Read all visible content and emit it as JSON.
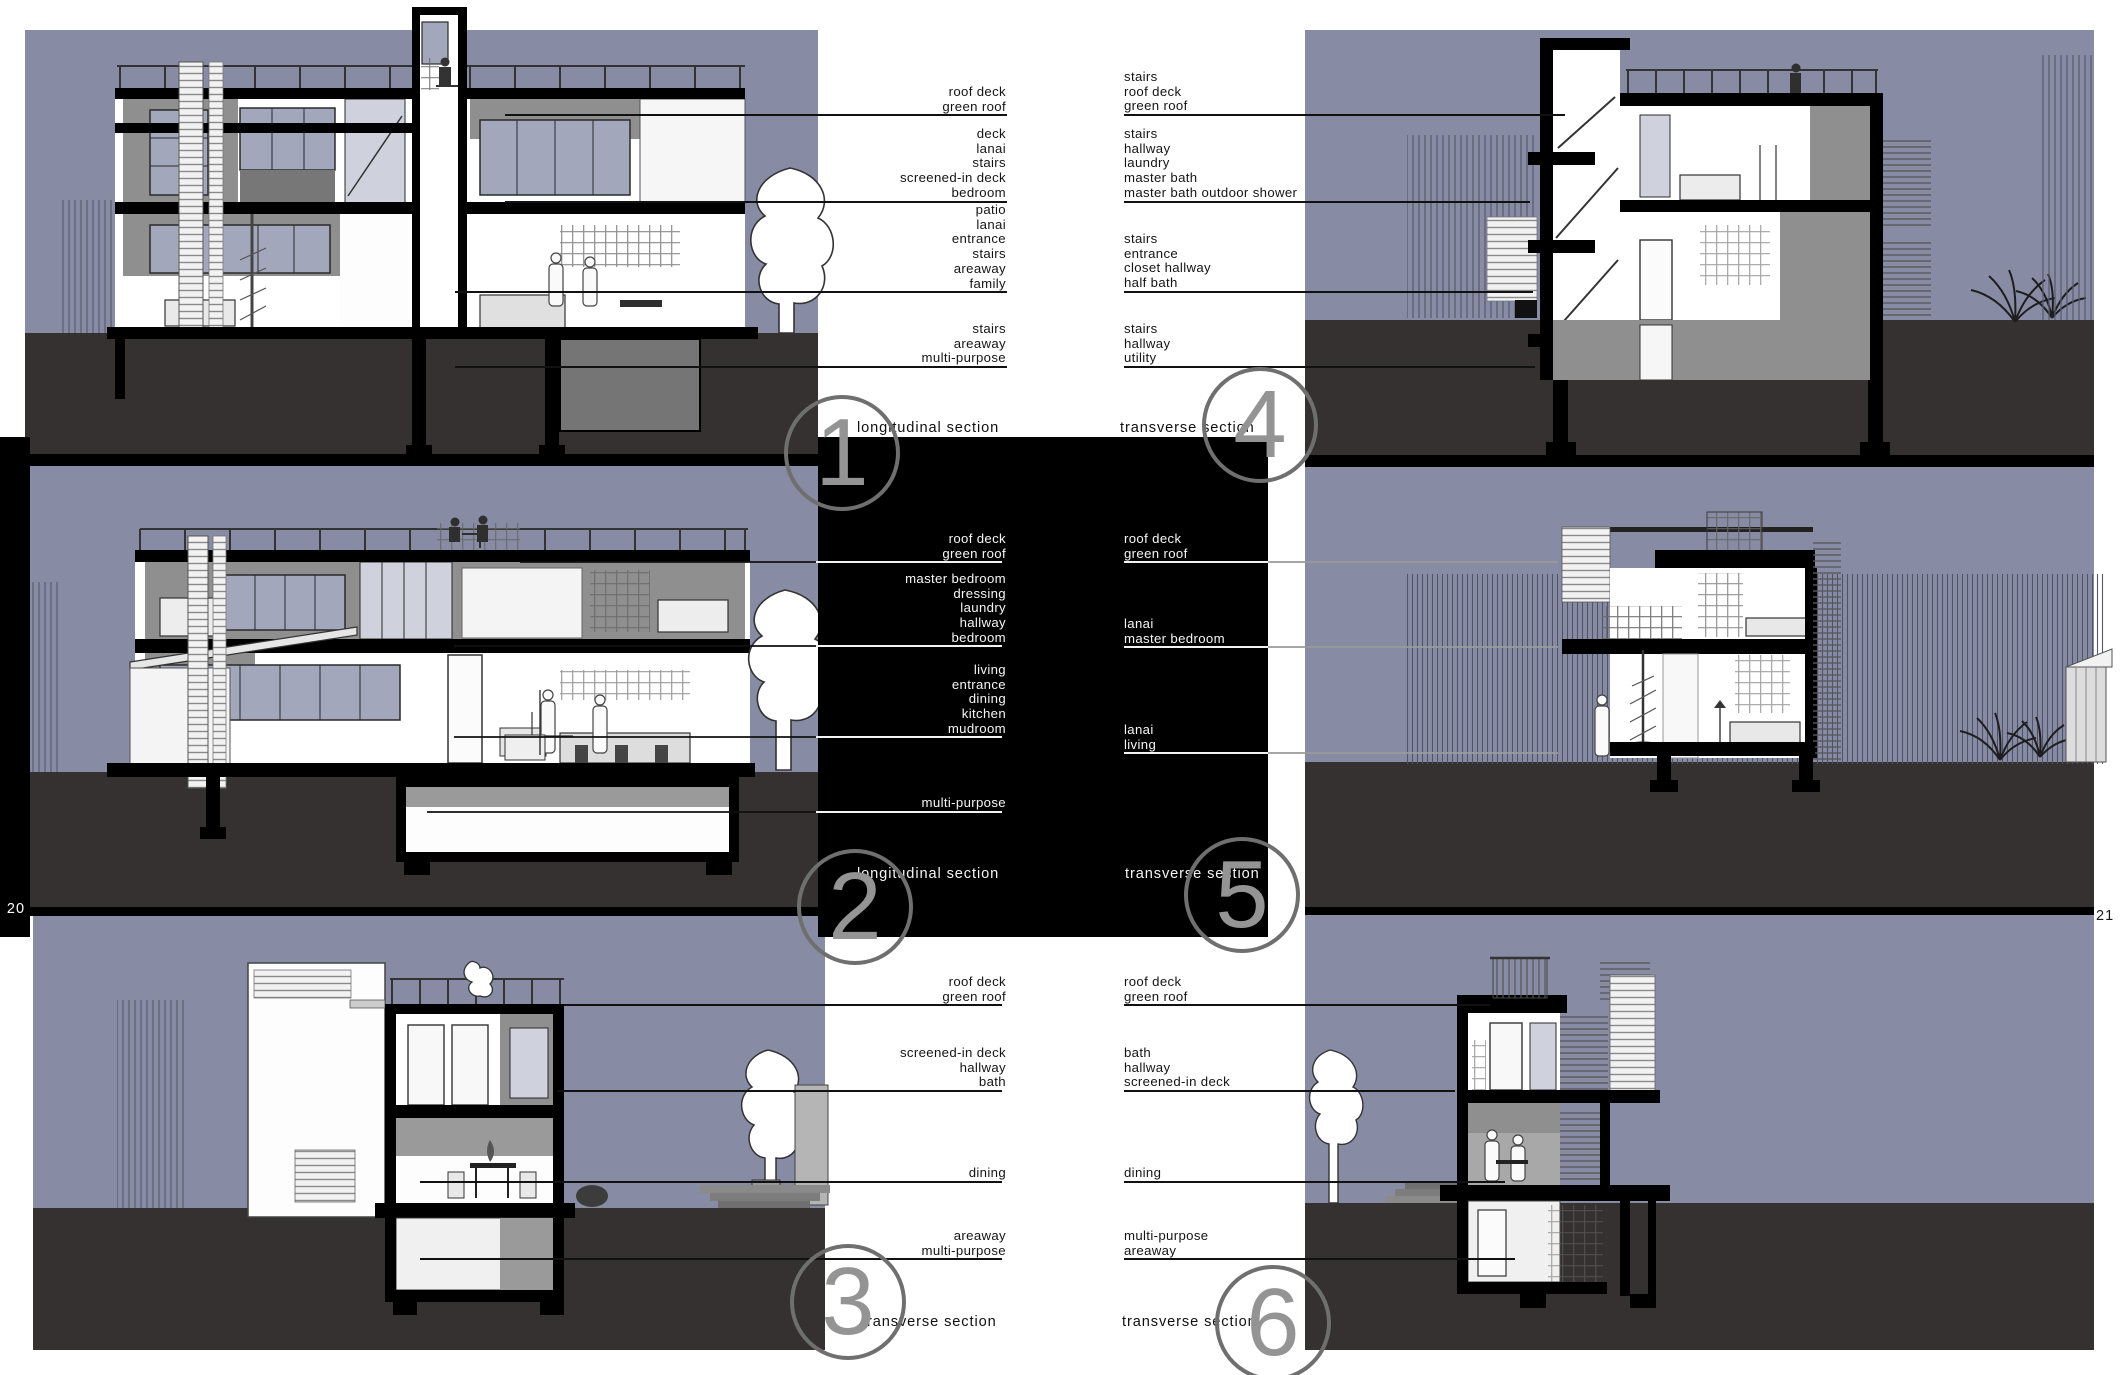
{
  "document": {
    "left_page_number": "20",
    "right_page_number": "21"
  },
  "colors": {
    "sky": "#878ba4",
    "ground": "#343130",
    "panel_black": "#000000",
    "circle_gray": "#6f6f6f",
    "numeral_gray": "#949494",
    "label_black": "#141414",
    "label_white": "#f6f6f6"
  },
  "sections": [
    {
      "number": "1",
      "caption": "longitudinal section",
      "labels": [
        [
          "roof deck",
          "green roof"
        ],
        [
          "deck",
          "lanai",
          "stairs",
          "screened-in deck",
          "bedroom"
        ],
        [
          "patio",
          "lanai",
          "entrance",
          "stairs",
          "areaway",
          "family"
        ],
        [
          "stairs",
          "areaway",
          "multi-purpose"
        ]
      ]
    },
    {
      "number": "4",
      "caption": "transverse section",
      "labels": [
        [
          "stairs",
          "roof deck",
          "green roof"
        ],
        [
          "stairs",
          "hallway",
          "laundry",
          "master bath",
          "master bath outdoor shower"
        ],
        [
          "stairs",
          "entrance",
          "closet hallway",
          "half bath"
        ],
        [
          "stairs",
          "hallway",
          "utility"
        ]
      ]
    },
    {
      "number": "2",
      "caption": "longitudinal section",
      "labels": [
        [
          "roof deck",
          "green roof"
        ],
        [
          "master bedroom",
          "dressing",
          "laundry",
          "hallway",
          "bedroom"
        ],
        [
          "living",
          "entrance",
          "dining",
          "kitchen",
          "mudroom"
        ],
        [
          "multi-purpose"
        ]
      ]
    },
    {
      "number": "5",
      "caption": "transverse section",
      "labels": [
        [
          "roof deck",
          "green roof"
        ],
        [
          "lanai",
          "master bedroom"
        ],
        [
          "lanai",
          "living"
        ]
      ]
    },
    {
      "number": "3",
      "caption": "transverse section",
      "labels": [
        [
          "roof deck",
          "green roof"
        ],
        [
          "screened-in deck",
          "hallway",
          "bath"
        ],
        [
          "dining"
        ],
        [
          "areaway",
          "multi-purpose"
        ]
      ]
    },
    {
      "number": "6",
      "caption": "transverse section",
      "labels": [
        [
          "roof deck",
          "green roof"
        ],
        [
          "bath",
          "hallway",
          "screened-in deck"
        ],
        [
          "dining"
        ],
        [
          "multi-purpose",
          "areaway"
        ]
      ]
    }
  ]
}
